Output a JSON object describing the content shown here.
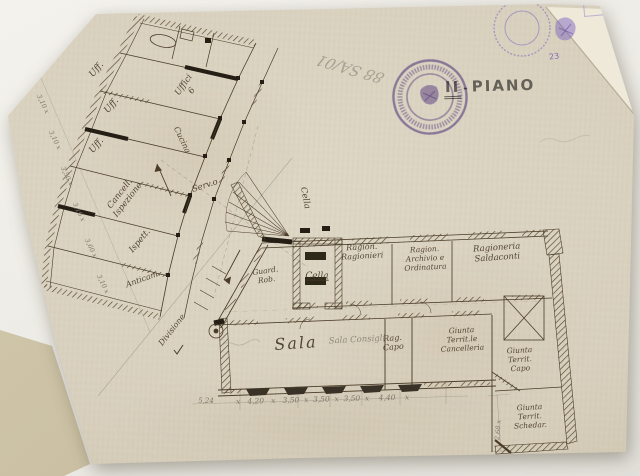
{
  "document": {
    "floor_numeral": "II",
    "floor_sep": "-",
    "floor_label": "PIANO",
    "archive_mark": "88 SA/01",
    "corner_number": "23"
  },
  "plan": {
    "labels": [
      {
        "id": "cella-room",
        "label": "Cella"
      },
      {
        "id": "cella-leader",
        "label": "Cella"
      },
      {
        "id": "guardaroba",
        "label": "Guard.\nRob."
      },
      {
        "id": "ragionieri",
        "label": "Ragion.\nRagionieri"
      },
      {
        "id": "archivio",
        "label": "Ragion.\nArchivio e\nOrdinatura"
      },
      {
        "id": "saldaconti",
        "label": "Ragioneria\nSaldaconti"
      },
      {
        "id": "sala",
        "label": "Sala"
      },
      {
        "id": "sala-pencil",
        "label": "Sala Consigli"
      },
      {
        "id": "rag-capo",
        "label": "Rag.\nCapo"
      },
      {
        "id": "giunta-cancelleria",
        "label": "Giunta\nTerrit.le\nCancelleria"
      },
      {
        "id": "giunta-capo",
        "label": "Giunta\nTerrit.\nCapo"
      },
      {
        "id": "giunta-schedario",
        "label": "Giunta\nTerrit.\nSchedar."
      },
      {
        "id": "divisione",
        "label": "Divisione"
      },
      {
        "id": "servizio",
        "label": "Serv.o"
      },
      {
        "id": "anticamera",
        "label": "Anticam."
      },
      {
        "id": "ispettore",
        "label": "Ispett."
      },
      {
        "id": "cancelleria-ispezione",
        "label": "Cancell.\nIspezione"
      },
      {
        "id": "uffici",
        "label": "Uffici\n6"
      },
      {
        "id": "cucina",
        "label": "Cucina"
      },
      {
        "id": "uff-1",
        "label": "Uff."
      },
      {
        "id": "uff-2",
        "label": "Uff."
      },
      {
        "id": "uff-3",
        "label": "Uff."
      }
    ],
    "dims_left": [
      "3,40 x",
      "3,10 x",
      "3,10 x",
      "3,50 x",
      "3,10 x",
      "3,60 x",
      "3,10 x"
    ],
    "dims_bottom_first": "5,24",
    "dims_bottom_row": "x   4,20   x   3,50  x  3,50  x  3,50  x    4,40    x",
    "dims_right": "2,68 x"
  },
  "colors": {
    "paper": "#d8d0bd",
    "ink": "#4a3c28",
    "pencil": "#8b8477",
    "stamp_purple": "#6d54ab"
  }
}
